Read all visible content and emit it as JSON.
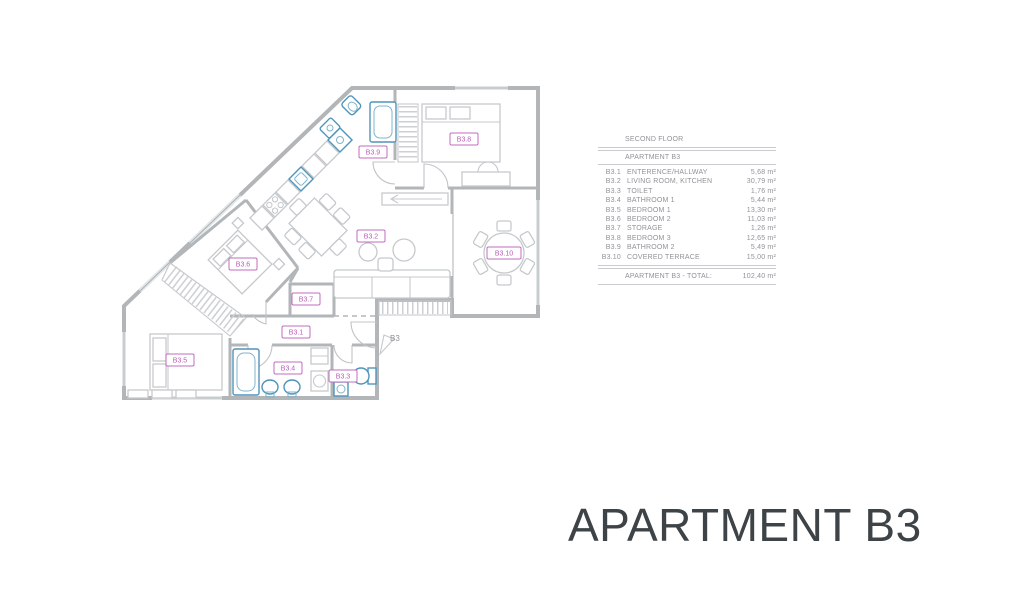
{
  "title": {
    "text": "APARTMENT B3"
  },
  "legend": {
    "floor_header": "SECOND FLOOR",
    "apartment_header": "APARTMENT B3",
    "rows": [
      {
        "code": "B3.1",
        "name": "ENTERENCE/HALLWAY",
        "area": "5,68 m²"
      },
      {
        "code": "B3.2",
        "name": "LIVING ROOM, KITCHEN",
        "area": "30,79 m²"
      },
      {
        "code": "B3.3",
        "name": "TOILET",
        "area": "1,76 m²"
      },
      {
        "code": "B3.4",
        "name": "BATHROOM 1",
        "area": "5,44 m²"
      },
      {
        "code": "B3.5",
        "name": "BEDROOM 1",
        "area": "13,30 m²"
      },
      {
        "code": "B3.6",
        "name": "BEDROOM 2",
        "area": "11,03 m²"
      },
      {
        "code": "B3.7",
        "name": "STORAGE",
        "area": "1,26 m²"
      },
      {
        "code": "B3.8",
        "name": "BEDROOM 3",
        "area": "12,65 m²"
      },
      {
        "code": "B3.9",
        "name": "BATHROOM 2",
        "area": "5,49 m²"
      },
      {
        "code": "B3.10",
        "name": "COVERED TERRACE",
        "area": "15,00 m²"
      }
    ],
    "total_label": "APARTMENT B3 - TOTAL:",
    "total_area": "102,40 m²"
  },
  "plan": {
    "entrance_label": "B3",
    "room_labels": [
      {
        "id": "B3.1"
      },
      {
        "id": "B3.2"
      },
      {
        "id": "B3.3"
      },
      {
        "id": "B3.4"
      },
      {
        "id": "B3.5"
      },
      {
        "id": "B3.6"
      },
      {
        "id": "B3.7"
      },
      {
        "id": "B3.8"
      },
      {
        "id": "B3.9"
      },
      {
        "id": "B3.10"
      }
    ],
    "colors": {
      "room_label": "#b85cb8",
      "walls": "#b2b6b9",
      "furniture": "#c5c9cc",
      "fixtures": "#4f94ba",
      "legend_text": "#8f9397",
      "title_text": "#3e4347"
    }
  }
}
